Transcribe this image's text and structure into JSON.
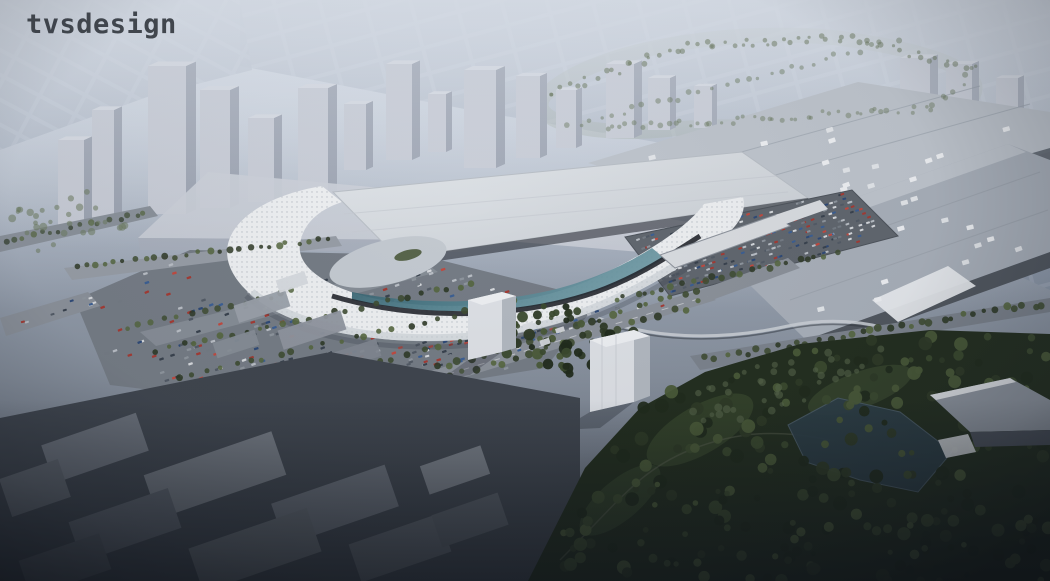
{
  "logo": {
    "text": "tvsdesign"
  },
  "scene": {
    "subject": "Aerial architectural rendering of a convention center campus: a flowing white canopy expansion joined to large flat-roof exhibit halls, surrounded by parking lots full of cars, tree-lined streets, a monorail line and a dark golf course, with hazy high-rise towers and a city grid on the horizon"
  },
  "palette": {
    "sky_top": "#cdd4de",
    "sky_upper": "#b7c0cd",
    "sky_mid": "#9aa4b3",
    "sky_low": "#79818e",
    "ground_low": "#575e69",
    "haze": "#dfe5ee",
    "city_street": "#97a2b3",
    "city_block": "#8692a4",
    "tower_face": "#c6cad4",
    "tower_side": "#99a0ae",
    "tower_top": "#d6dae2",
    "podium": "#c9cdd6",
    "podium_front": "#a9afbb",
    "hall_roof": "#a9b0ba",
    "hall_roof_light": "#bfc5cd",
    "hall_edge_dark": "#565c65",
    "roof_light": "#e0e4e8",
    "roof_dark": "#cbd0d6",
    "canopy": "#edeff1",
    "canopy_shade": "#c7cdd3",
    "perforation": "#a9b0b8",
    "glass_dark": "#2b5563",
    "glass_light": "#6f9aa5",
    "entry_dark": "#23272e",
    "plaza": "#c3c9d0",
    "asphalt": "#757c85",
    "asphalt_light": "#979da6",
    "road": "#8b919a",
    "road_dark": "#666c75",
    "lane": "#ffffff",
    "bridge": "#d9dce0",
    "monorail": "#ccd1d7",
    "block_dark": "#454b54",
    "white_face": "#dde0e5",
    "white_side": "#b2b8c0",
    "white_roof": "#edeff2",
    "golf": "#232e1f",
    "fairway": "#36452c",
    "pond": "#2d3e47",
    "vignette": "#0e1219",
    "logo": "#2e333a"
  },
  "vegetation": {
    "street_tree_colors": [
      "#3f4d33",
      "#55663f",
      "#2f3a27"
    ],
    "golf_tree_colors": [
      "#212b1c",
      "#2e3a26",
      "#3b4a2e",
      "#4a5a38"
    ],
    "haze_tree_color": "#6b7a5f"
  },
  "cars": {
    "colors": [
      "#d6d9dd",
      "#b9bec5",
      "#8e959d",
      "#535b66",
      "#39424e",
      "#a33b34",
      "#c04a40",
      "#3c5f93",
      "#2f4a77",
      "#747b84"
    ]
  },
  "counts": {
    "west_lot_cars": 300,
    "central_lot_cars": 270,
    "street_cars": 100,
    "rooftop_units": 34,
    "golf_trees": 250
  }
}
